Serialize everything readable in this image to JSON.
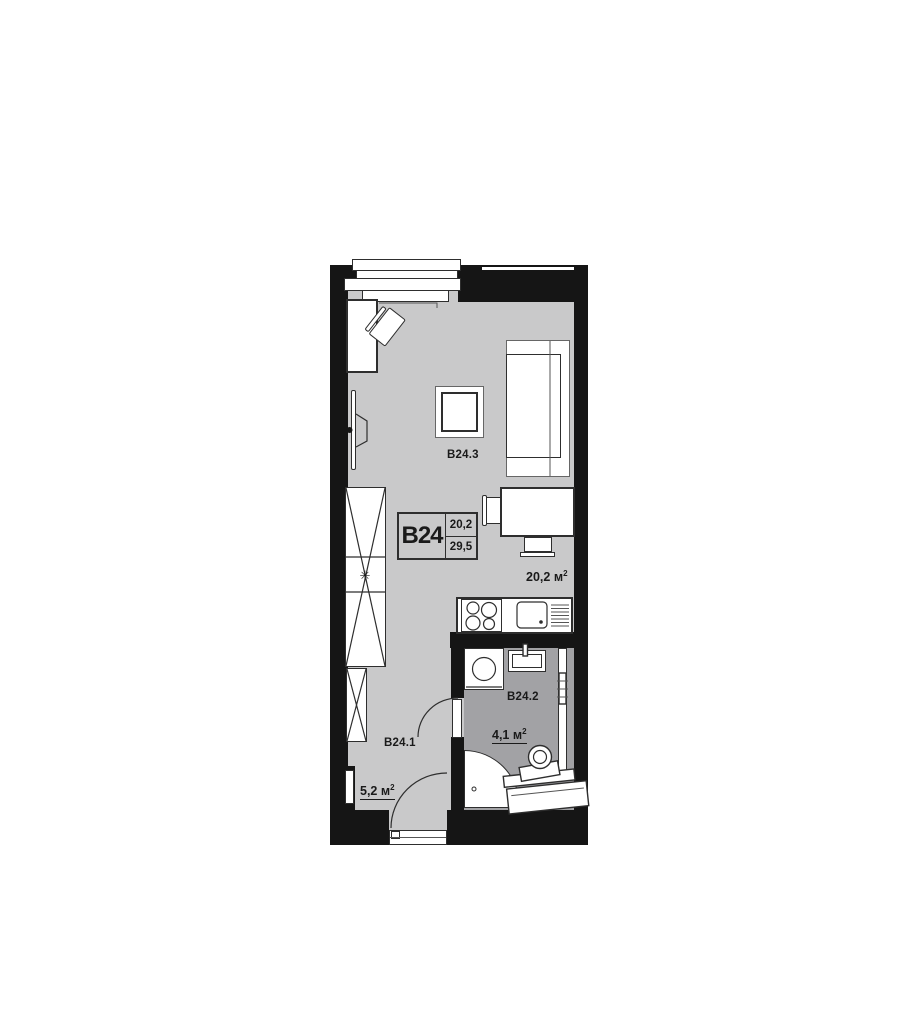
{
  "colors": {
    "page_bg": "#ffffff",
    "wall": "#151515",
    "floor_main": "#c9c9ca",
    "floor_bath": "#a2a2a5",
    "line": "#2e2e2e",
    "text": "#1a1a1a"
  },
  "unit_card": {
    "code": "B24",
    "upper_value": "20,2",
    "lower_value": "29,5"
  },
  "rooms": {
    "living": {
      "id": "B24.3",
      "area_value": "20,2",
      "area_unit": "м",
      "area_sup": "2"
    },
    "hall": {
      "id": "B24.1",
      "area_value": "5,2",
      "area_unit": "м",
      "area_sup": "2"
    },
    "bath": {
      "id": "B24.2",
      "area_value": "4,1",
      "area_unit": "м",
      "area_sup": "2"
    }
  },
  "icons": {
    "ventilation_star": "✳"
  }
}
